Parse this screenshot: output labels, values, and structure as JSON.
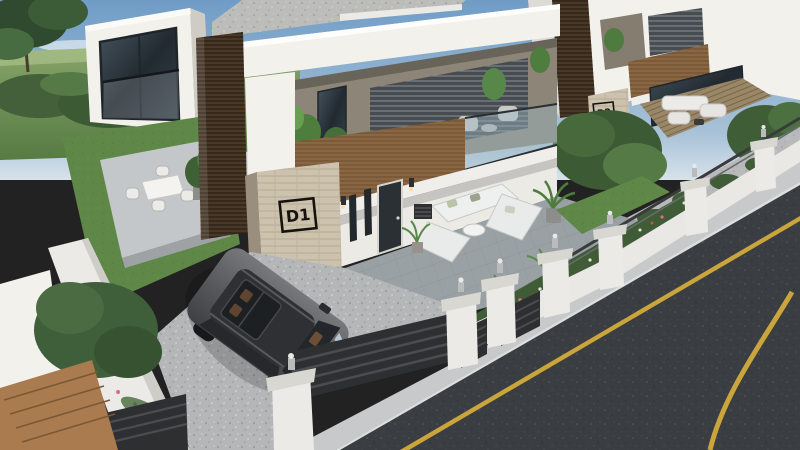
{
  "scene": {
    "title": "Modern duplex villa project 3D exterior render",
    "view": "aerial three-quarter view of white villas with wood accents, front yards, parked SUV and asphalt street"
  },
  "labels": {
    "unit1": "D1",
    "unit2": "D2"
  },
  "palette": {
    "skyTop": "#6f9cc6",
    "skyHorizon": "#d8e2ea",
    "fieldGreen": "#6a8f52",
    "lawnGreen": "#5f8747",
    "foliageDark": "#3c5a34",
    "wallWhite": "#f2f1ec",
    "woodSlat": "#8a6742",
    "woodDark": "#4a3826",
    "stoneBeige": "#cdc2ae",
    "terraceGray": "#9aa1a5",
    "drivewayGray": "#b4b6b8",
    "sidewalkGray": "#c7c9ca",
    "roadAsphalt": "#3a3d41",
    "laneYellow": "#c9a53c",
    "carBody": "#595a5e",
    "glassTint": "#9db8c4",
    "signInk": "#16130f"
  }
}
